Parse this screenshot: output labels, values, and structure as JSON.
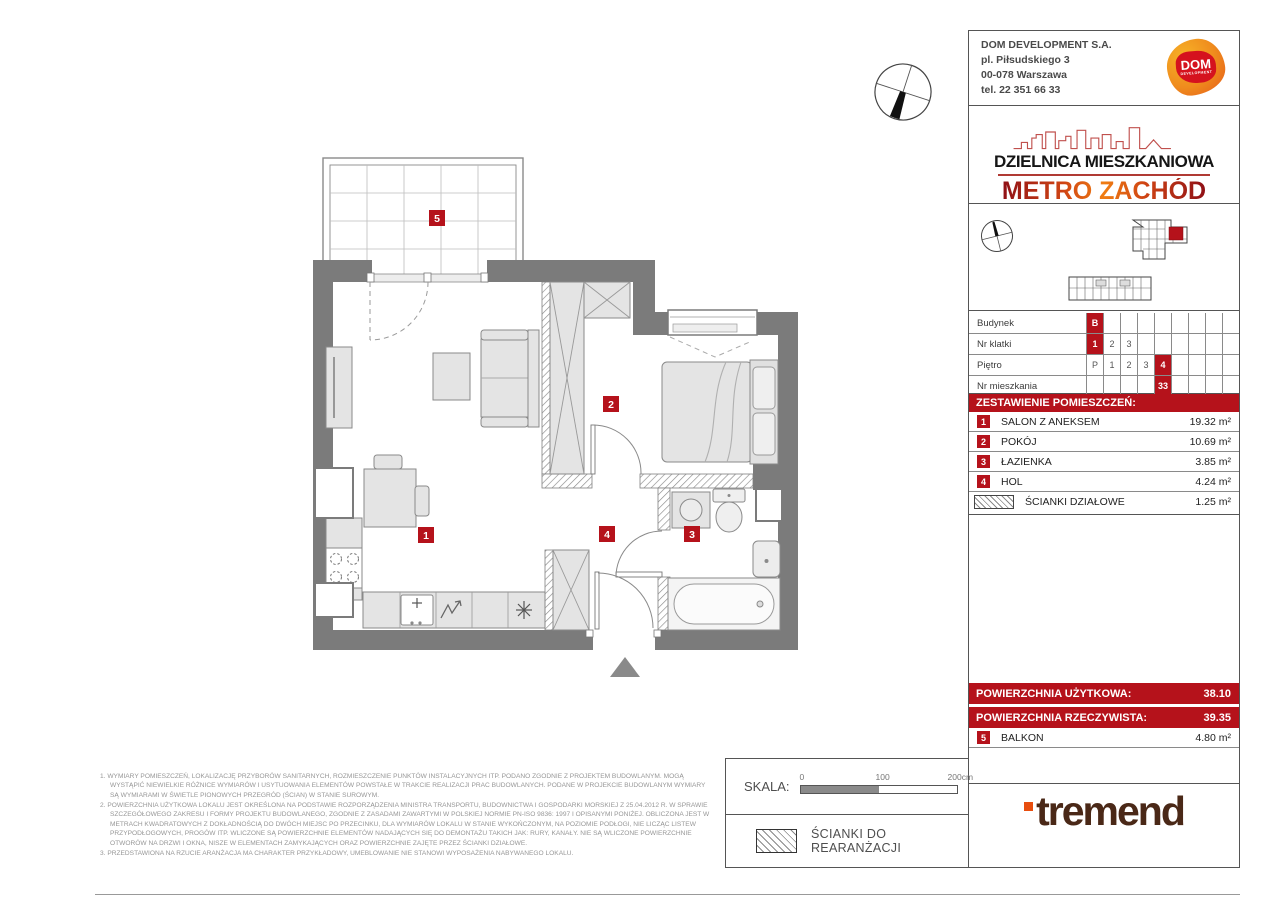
{
  "company": {
    "name": "DOM DEVELOPMENT S.A.",
    "address1": "pl. Piłsudskiego 3",
    "address2": "00-078 Warszawa",
    "phone": "tel. 22 351 66 33",
    "logo_line1": "DOM",
    "logo_line2": "DEVELOPMENT"
  },
  "brand": {
    "district": "DZIELNICA MIESZKANIOWA",
    "project": "METRO ZACHÓD"
  },
  "location_table": {
    "rows": [
      {
        "label": "Budynek",
        "cells": [
          {
            "text": "B"
          },
          {
            "text": ""
          },
          {
            "text": ""
          },
          {
            "text": ""
          },
          {
            "text": ""
          },
          {
            "text": ""
          },
          {
            "text": ""
          },
          {
            "text": ""
          },
          {
            "text": ""
          }
        ]
      },
      {
        "label": "Nr klatki",
        "cells": [
          {
            "text": "1"
          },
          {
            "text": "2"
          },
          {
            "text": "3"
          },
          {
            "text": ""
          },
          {
            "text": ""
          },
          {
            "text": ""
          },
          {
            "text": ""
          },
          {
            "text": ""
          },
          {
            "text": ""
          }
        ]
      },
      {
        "label": "Piętro",
        "cells": [
          {
            "text": "P"
          },
          {
            "text": "1"
          },
          {
            "text": "2"
          },
          {
            "text": "3"
          },
          {
            "text": "4"
          },
          {
            "text": ""
          },
          {
            "text": ""
          },
          {
            "text": ""
          },
          {
            "text": ""
          }
        ]
      },
      {
        "label": "Nr mieszkania",
        "cells": [
          {
            "text": ""
          },
          {
            "text": ""
          },
          {
            "text": ""
          },
          {
            "text": ""
          },
          {
            "text": "33"
          },
          {
            "text": ""
          },
          {
            "text": ""
          },
          {
            "text": ""
          },
          {
            "text": ""
          }
        ]
      }
    ]
  },
  "rooms": {
    "header": "ZESTAWIENIE POMIESZCZEŃ:",
    "items": [
      {
        "no": "1",
        "name": "SALON Z ANEKSEM",
        "area": "19.32 m²"
      },
      {
        "no": "2",
        "name": "POKÓJ",
        "area": "10.69 m²"
      },
      {
        "no": "3",
        "name": "ŁAZIENKA",
        "area": "3.85 m²"
      },
      {
        "no": "4",
        "name": "HOL",
        "area": "4.24 m²"
      }
    ],
    "partitions": {
      "name": "ŚCIANKI DZIAŁOWE",
      "area": "1.25 m²"
    }
  },
  "summary": {
    "usable_label": "POWIERZCHNIA UŻYTKOWA:",
    "usable_value": "38.10",
    "actual_label": "POWIERZCHNIA RZECZYWISTA:",
    "actual_value": "39.35",
    "balcony": {
      "no": "5",
      "name": "BALKON",
      "area": "4.80 m²"
    }
  },
  "plan_labels": {
    "salon": "1",
    "pokoj": "2",
    "lazienka": "3",
    "hol": "4",
    "balkon": "5"
  },
  "scale": {
    "label": "SKALA:",
    "tick0": "0",
    "tick100": "100",
    "tick200": "200cm"
  },
  "legend": {
    "rearrangement": "ŚCIANKI DO REARANŻACJI"
  },
  "footnotes": {
    "items": [
      "1. WYMIARY POMIESZCZEŃ, LOKALIZACJĘ PRZYBORÓW SANITARNYCH, ROZMIESZCZENIE PUNKTÓW INSTALACYJNYCH ITP. PODANO ZGODNIE Z PROJEKTEM BUDOWLANYM. MOGĄ WYSTĄPIĆ NIEWIELKIE RÓŻNICE WYMIARÓW I USYTUOWANIA ELEMENTÓW POWSTAŁE W TRAKCIE REALIZACJI PRAC BUDOWLANYCH. PODANE W PROJEKCIE BUDOWLANYM WYMIARY SĄ WYMIARAMI W ŚWIETLE PIONOWYCH PRZEGRÓD (ŚCIAN) W STANIE SUROWYM.",
      "2. POWIERZCHNIA UŻYTKOWA LOKALU JEST OKREŚLONA NA PODSTAWIE ROZPORZĄDZENIA MINISTRA TRANSPORTU, BUDOWNICTWA I GOSPODARKI MORSKIEJ Z 25.04.2012 R. W SPRAWIE SZCZEGÓŁOWEGO ZAKRESU I FORMY PROJEKTU BUDOWLANEGO, ZGODNIE Z ZASADAMI ZAWARTYMI W POLSKIEJ NORMIE PN-ISO 9836: 1997 I OPISANYMI PONIŻEJ. OBLICZONA JEST W METRACH KWADRATOWYCH Z DOKŁADNOŚCIĄ DO DWÓCH MIEJSC PO PRZECINKU, DLA WYMIARÓW LOKALU W STANIE WYKOŃCZONYM, NA POZIOMIE PODŁOGI, NIE LICZĄC LISTEW PRZYPODŁOGOWYCH, PROGÓW ITP. WLICZONE SĄ POWIERZCHNIE ELEMENTÓW NADAJĄCYCH SIĘ DO DEMONTAŻU TAKICH JAK: RURY, KANAŁY. NIE SĄ WLICZONE POWIERZCHNIE OTWORÓW NA DRZWI I OKNA, NISZE W ELEMENTACH ZAMYKAJĄCYCH ORAZ POWIERZCHNIE ZAJĘTE PRZEZ ŚCIANKI DZIAŁOWE.",
      "3. PRZEDSTAWIONA NA RZUCIE ARANŻACJA MA CHARAKTER PRZYKŁADOWY, UMEBLOWANIE NIE STANOWI WYPOSAŻENIA NABYWANEGO LOKALU."
    ]
  },
  "footer_logo": {
    "text": "tremend"
  },
  "colors": {
    "accent_red": "#b5121b",
    "wall_gray": "#7b7b7b",
    "logo_orange": "#ef8b1d",
    "logo_red": "#d5121e",
    "tremend_brown": "#4a2817"
  }
}
